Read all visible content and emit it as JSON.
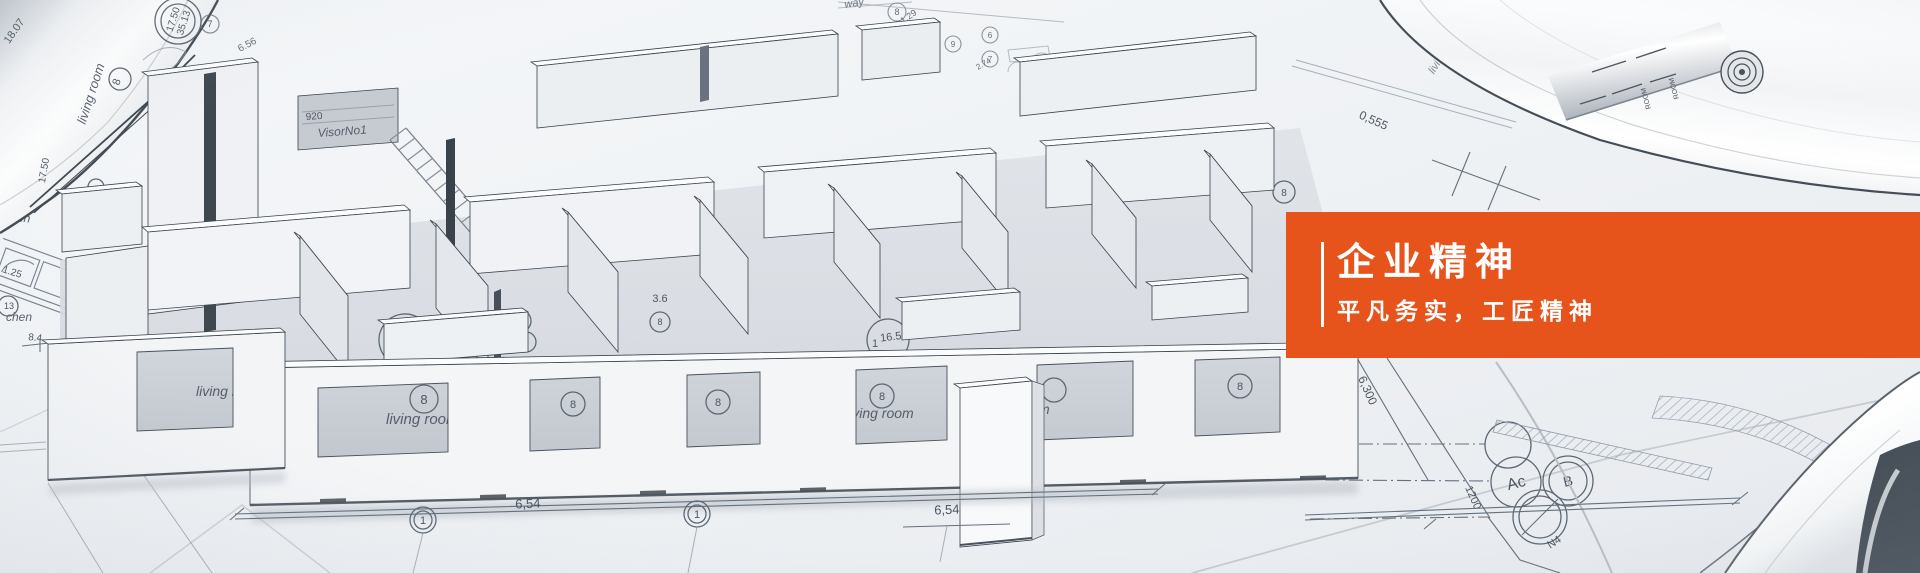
{
  "meta": {
    "width": 1920,
    "height": 573
  },
  "banner": {
    "title": "企业精神",
    "subtitle": "平凡务实，工匠精神",
    "panel_color": "#e6541c",
    "text_color": "#ffffff"
  },
  "blueprint": {
    "room_labels": {
      "living_room": "living room",
      "room_caps": "ROOM",
      "kitchen_partial": "chen",
      "hallway_partial": "way",
      "visor": "VisorNo1"
    },
    "dims": {
      "d1750": "17.50",
      "d3513": "35.13",
      "d1659": "16.59",
      "d654": "6,54",
      "d656": "6.56",
      "d129": "1.29",
      "d274": "2.74",
      "d125": "1.25",
      "d84": "8.4",
      "d36": "3.6",
      "d6300": "6,300",
      "d1200": "1200",
      "d0555": "0,555",
      "d1807": "18.07",
      "d920": "920",
      "n4": "N4"
    },
    "markers": {
      "m1": "1",
      "m6": "6",
      "m7": "7",
      "m8": "8",
      "m9": "9",
      "m10": "10",
      "m13": "13",
      "ac": "Ac",
      "b": "B"
    }
  }
}
